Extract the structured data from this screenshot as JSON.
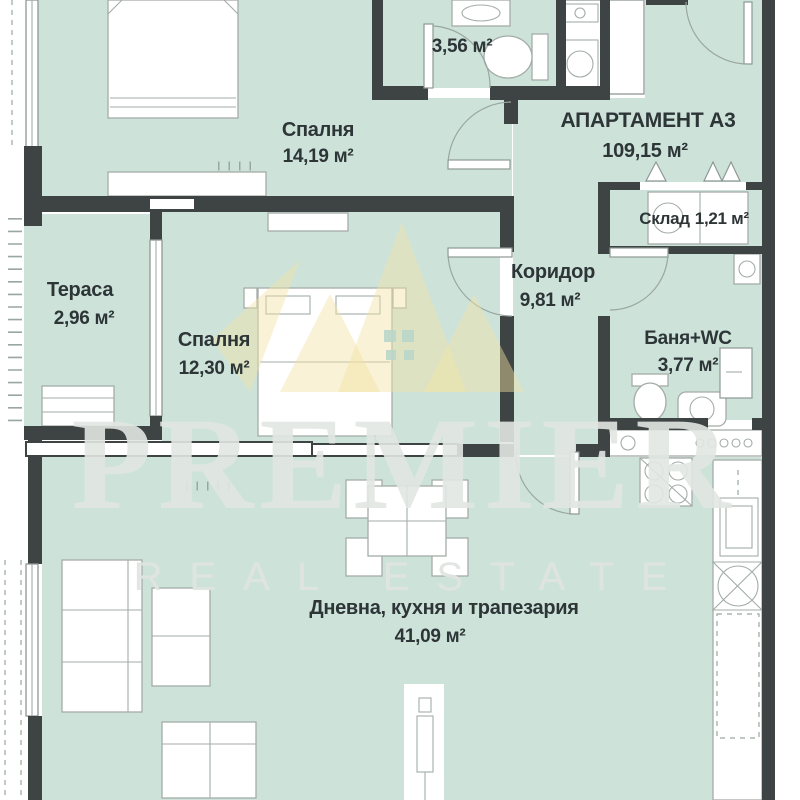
{
  "plan": {
    "type": "apartment-floor-plan",
    "apartment": {
      "title": "АПАРТАМЕНТ А3",
      "area": "109,15 м²"
    },
    "rooms": {
      "bedroom1": {
        "name": "Спалня",
        "area": "14,19 м²"
      },
      "bedroom2": {
        "name": "Спалня",
        "area": "12,30 м²"
      },
      "bathroom_top": {
        "area": "3,56 м²"
      },
      "terrace": {
        "name": "Тераса",
        "area": "2,96 м²"
      },
      "corridor": {
        "name": "Коридор",
        "area": "9,81 м²"
      },
      "storage": {
        "name": "Склад",
        "area": "1,21 м²"
      },
      "bathroom_wc": {
        "name": "Баня+WC",
        "area": "3,77 м²"
      },
      "living": {
        "name": "Дневна, кухня и трапезария",
        "area": "41,09 м²"
      }
    }
  },
  "watermark": {
    "brand": "PREMIER",
    "tagline": "REAL ESTATE"
  },
  "palette": {
    "floor_green": "#cde3da",
    "wall_dark": "#3e4343",
    "furniture_line": "#a3aca8",
    "label_text": "#2d3537",
    "watermark_text": "#e2e7e3",
    "crown_gold": "#f2e2a4"
  }
}
